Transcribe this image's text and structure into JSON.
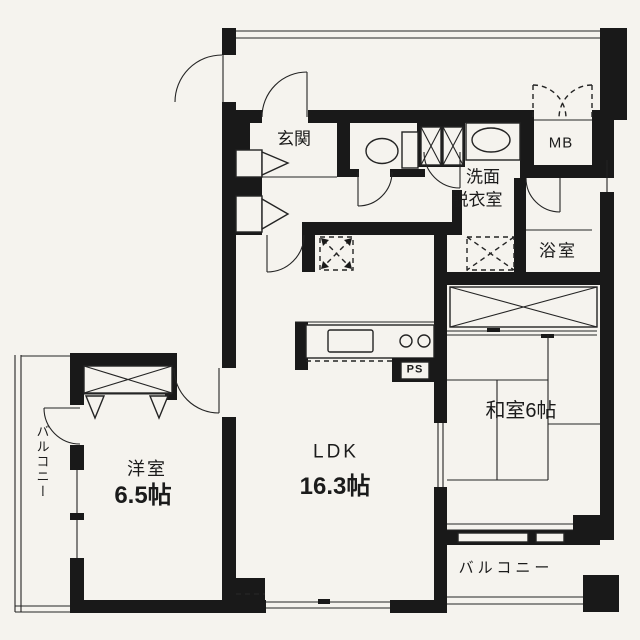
{
  "floorplan": {
    "type": "japanese-apartment-floorplan",
    "rooms": {
      "genkan": {
        "label": "玄関"
      },
      "washroom": {
        "line1": "洗面",
        "line2": "脱衣室"
      },
      "meter_box": {
        "label": "MB"
      },
      "bathroom": {
        "label": "浴室"
      },
      "japanese_room": {
        "label": "和室6帖"
      },
      "ldk": {
        "label": "LDK",
        "size": "16.3帖"
      },
      "western_room": {
        "label": "洋室",
        "size": "6.5帖"
      },
      "balcony_left": {
        "label": "バルコニー"
      },
      "balcony_bottom": {
        "label": "バルコニー"
      },
      "pipe_space": {
        "label": "PS"
      }
    },
    "colors": {
      "wall": "#191919",
      "line": "#242424",
      "paper": "#f5f3ee"
    }
  }
}
